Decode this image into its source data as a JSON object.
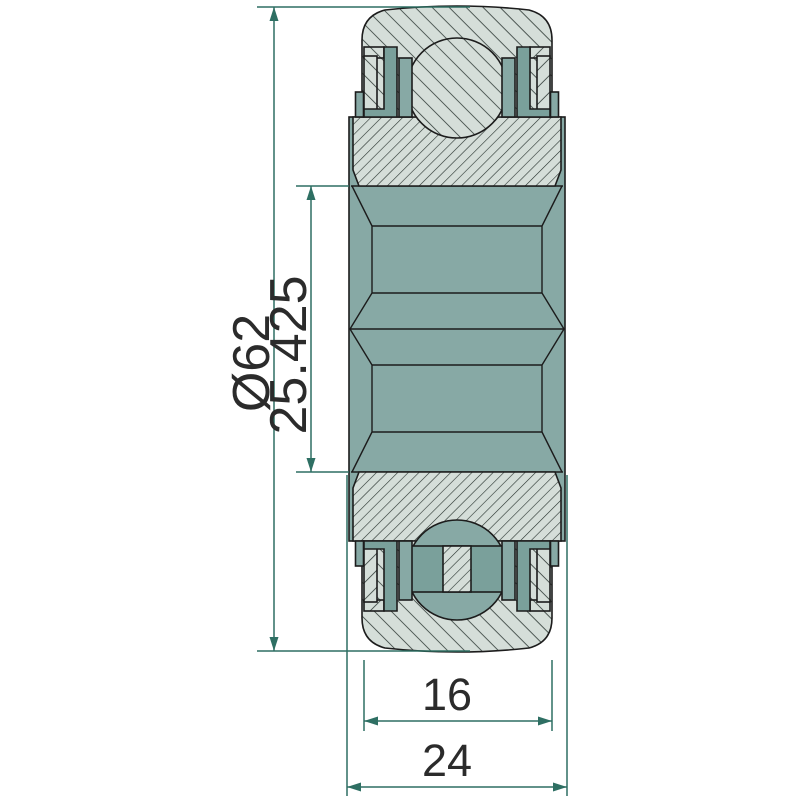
{
  "drawing": {
    "title": "Sealed ball bearing insert with extended inner ring - cross-section drawing",
    "dimensions": {
      "outer_diameter": {
        "label": "Ø62",
        "meaning": "outer diameter"
      },
      "bore_diameter": {
        "label": "25.425",
        "meaning": "bore diameter"
      },
      "outer_ring_width": {
        "label": "16",
        "meaning": "outer ring width"
      },
      "inner_ring_width": {
        "label": "24",
        "meaning": "inner ring total width"
      }
    },
    "colors": {
      "background": "#ffffff",
      "part_fill_light": "#d5ded9",
      "part_fill_teal": "#87a9a5",
      "part_fill_teal_dark": "#7aa09b",
      "outline": "#1c1c1c",
      "dimension": "#2e6f63",
      "label_text": "#2b2b2b"
    }
  }
}
